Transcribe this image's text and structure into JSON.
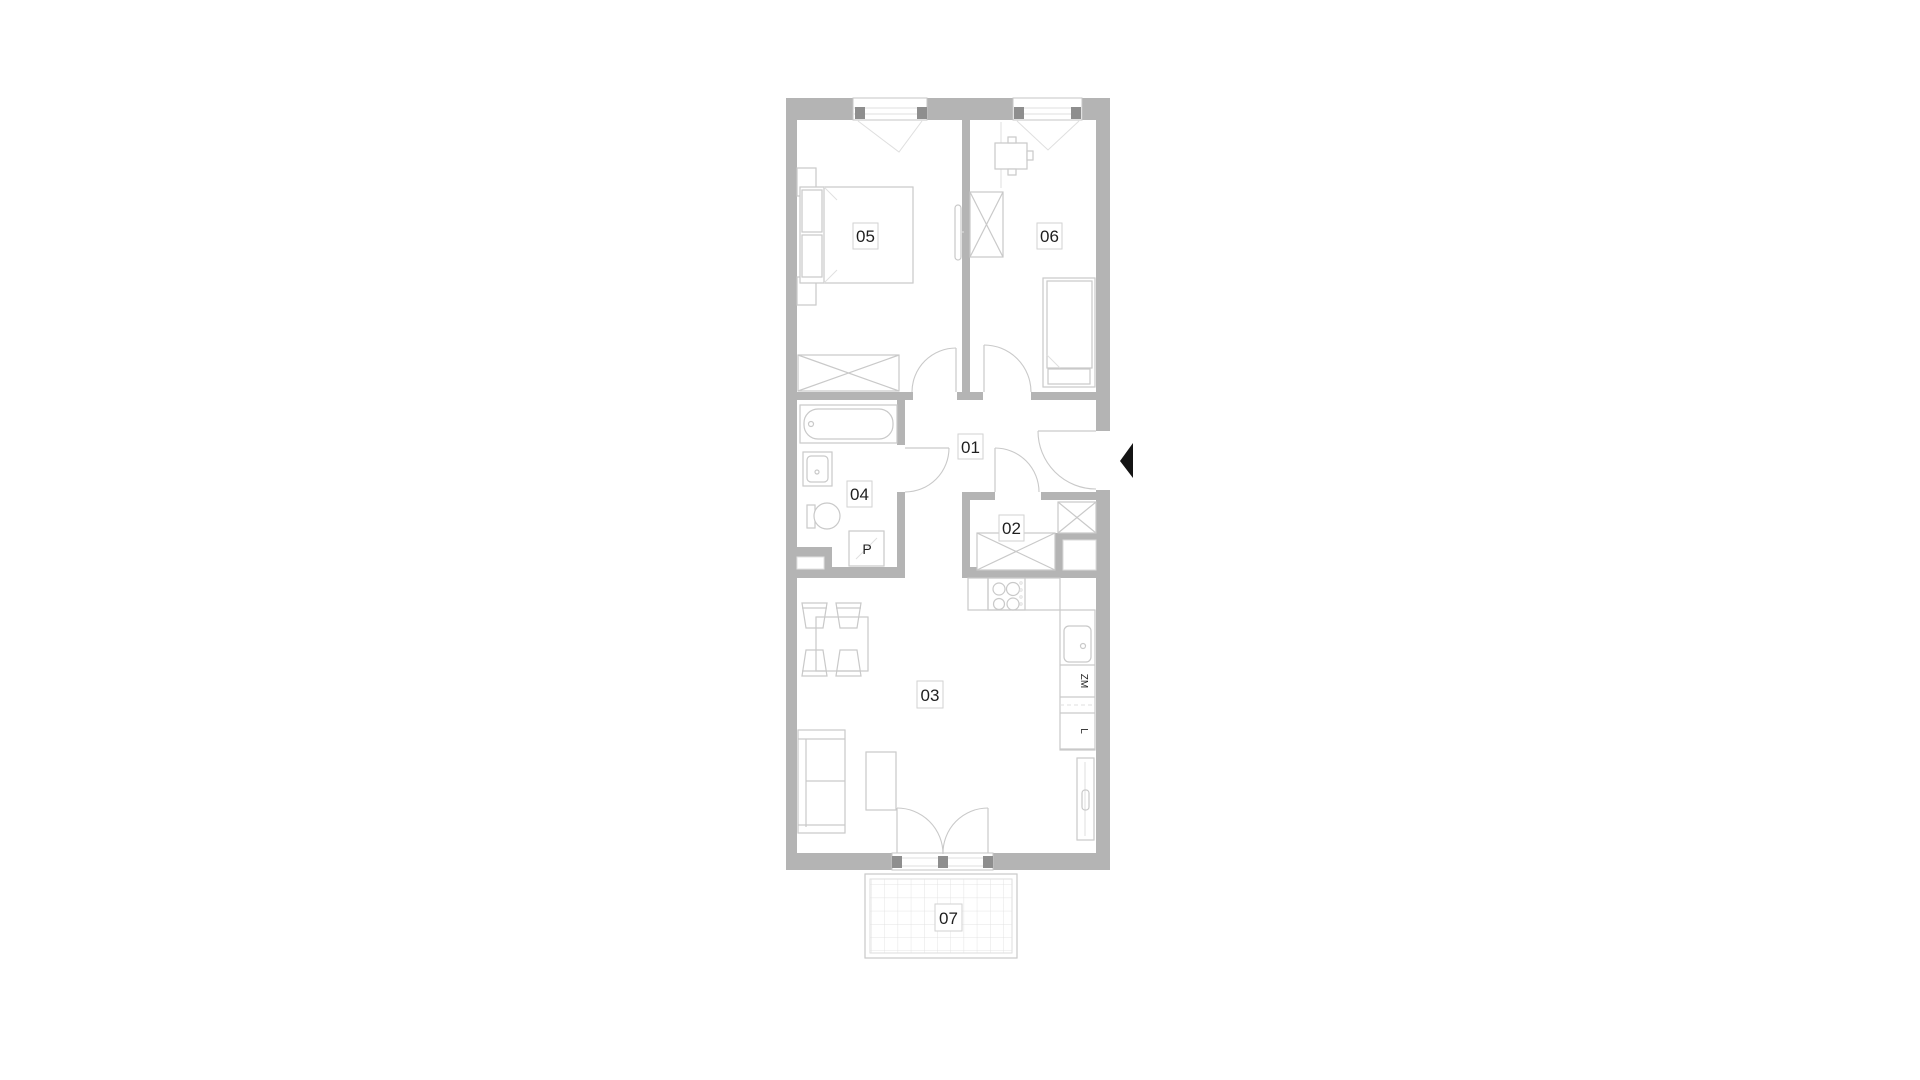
{
  "palette": {
    "wall": "#b4b4b4",
    "wall_dark": "#8e8e8e",
    "furniture_line": "#c9c9c9",
    "furniture_line_light": "#dfdfdf",
    "label_border": "#d2d2d2",
    "text": "#1f1f1f",
    "entrance_marker": "#141414",
    "background": "#ffffff"
  },
  "plan": {
    "rooms": [
      {
        "id": "01",
        "label": "01"
      },
      {
        "id": "02",
        "label": "02"
      },
      {
        "id": "03",
        "label": "03"
      },
      {
        "id": "04",
        "label": "04"
      },
      {
        "id": "05",
        "label": "05"
      },
      {
        "id": "06",
        "label": "06"
      },
      {
        "id": "07",
        "label": "07"
      }
    ],
    "appliances": {
      "washing_machine_label": "P",
      "dishwasher_label": "ZM",
      "fridge_label": "L"
    }
  }
}
